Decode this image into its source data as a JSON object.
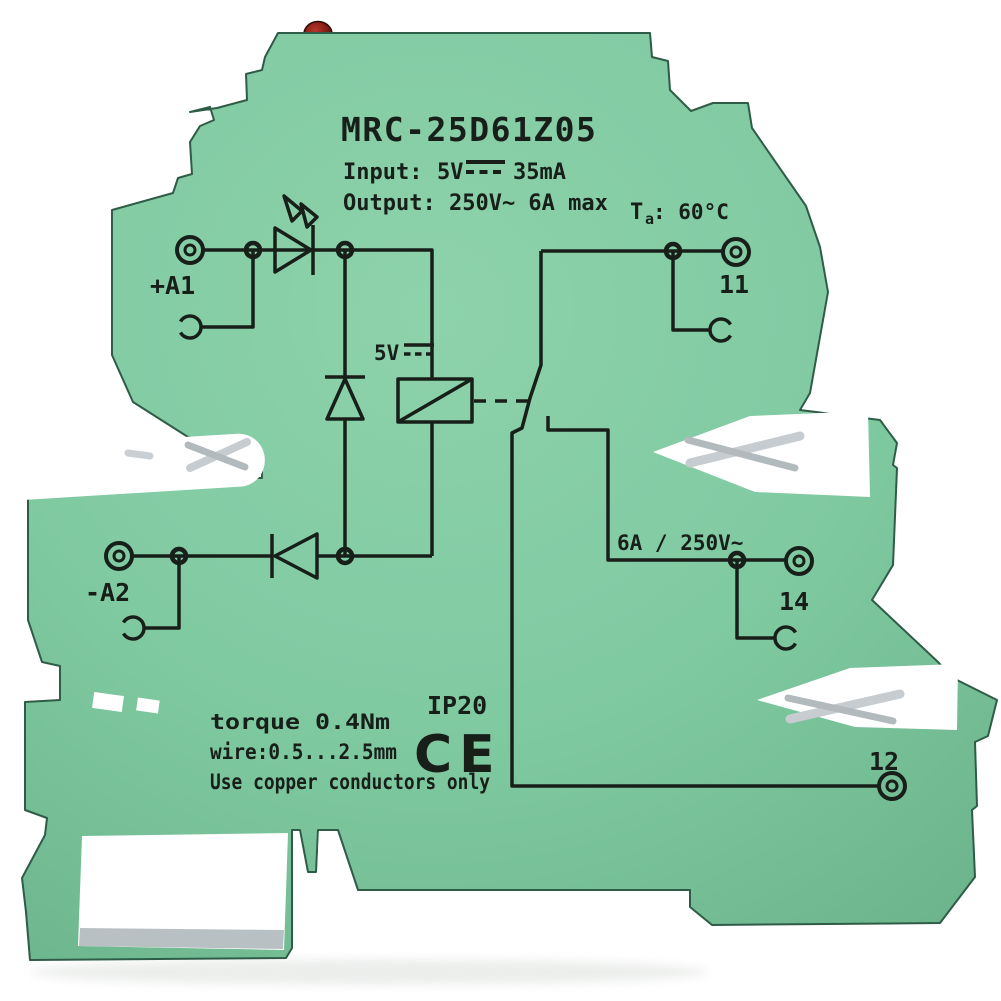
{
  "product": {
    "model": "MRC-25D61Z05",
    "input_label": "Input:",
    "input_voltage": "5V",
    "input_current": "35mA",
    "output_line": "Output: 250V~  6A  max",
    "ambient_temp_prefix": "T",
    "ambient_temp_sub": "a",
    "ambient_temp_value": ": 60°C"
  },
  "schematic": {
    "terminal_a1": "+A1",
    "terminal_a2": "-A2",
    "terminal_11": "11",
    "terminal_12": "12",
    "terminal_14": "14",
    "coil_voltage": "5V",
    "contact_rating": "6A / 250V~"
  },
  "markings": {
    "ip_rating": "IP20",
    "ce_mark": "CE",
    "torque": "torque 0.4Nm",
    "wire_range": "wire:0.5...2.5mm",
    "copper_note": "Use copper conductors only"
  },
  "colors": {
    "housing_green": "#7FC9A1",
    "ink": "#181F19",
    "led_red": "#7E1B12",
    "metal": "#C7CDD2"
  }
}
